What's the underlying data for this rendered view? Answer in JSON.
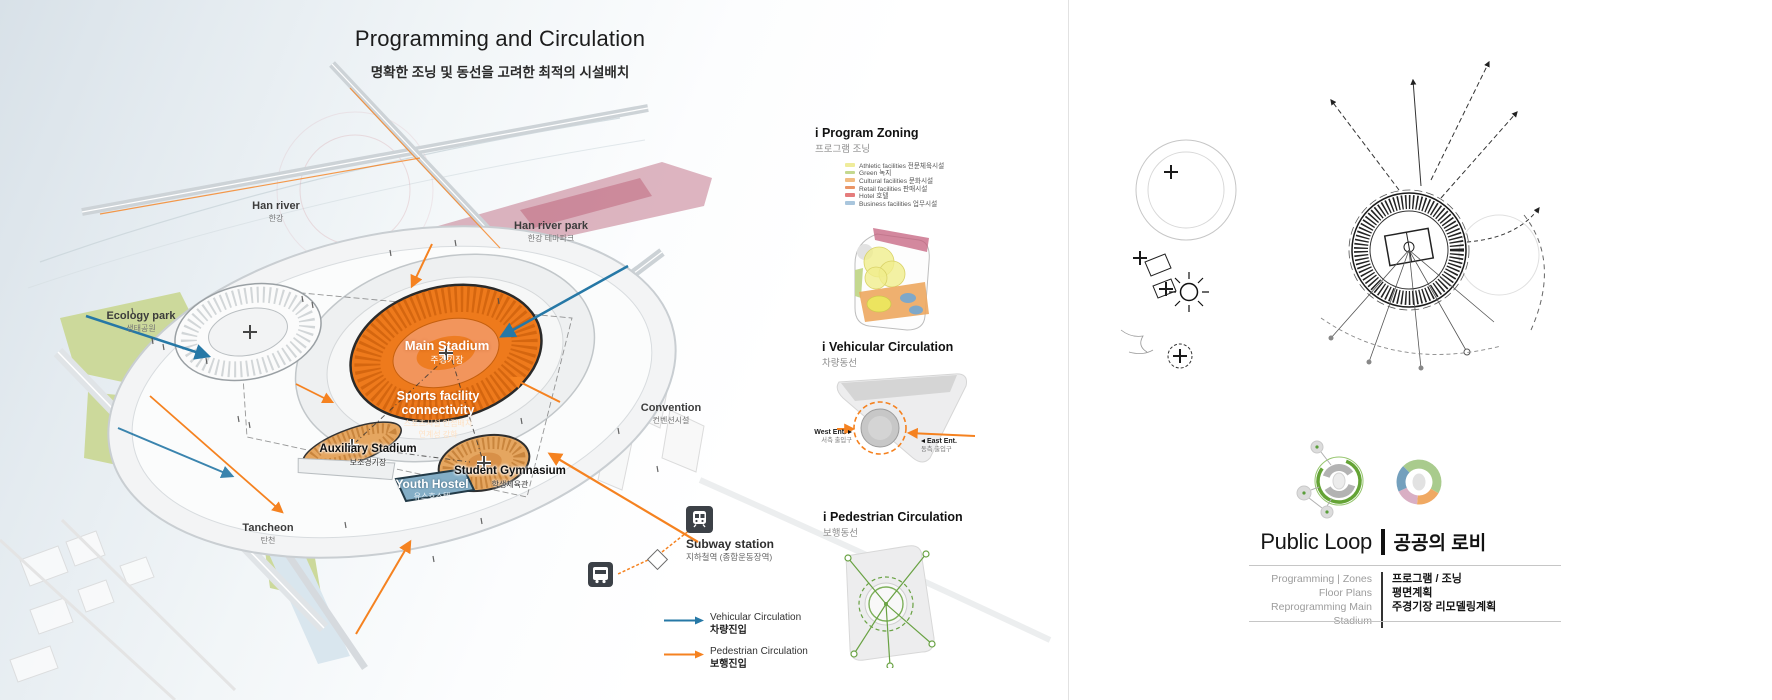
{
  "left_board": {
    "title": "Programming and Circulation",
    "subtitle_ko": "명확한 조닝 및 동선을 고려한 최적의 시설배치",
    "map_labels": {
      "han_river": {
        "en": "Han river",
        "ko": "한강"
      },
      "han_river_park": {
        "en": "Han river park",
        "ko": "한강 테마파크"
      },
      "ecology_park": {
        "en": "Ecology park",
        "ko": "생태공원"
      },
      "tancheon": {
        "en": "Tancheon",
        "ko": "탄천"
      },
      "convention": {
        "en": "Convention",
        "ko": "컨벤션시설"
      },
      "main_stadium": {
        "en": "Main Stadium",
        "ko": "주경기장"
      },
      "connectivity": {
        "en": "Sports facility connectivity",
        "ko1": "스포츠시설 인접배치",
        "ko2": "연계성 강화"
      },
      "auxiliary_stadium": {
        "en": "Auxiliary Stadium",
        "ko": "보조경기장"
      },
      "youth_hostel": {
        "en": "Youth Hostel",
        "ko": "유스호스텔"
      },
      "student_gymnasium": {
        "en": "Student Gymnasium",
        "ko": "학생체육관"
      },
      "subway_station": {
        "en": "Subway station",
        "ko": "지하철역 (종합운동장역)"
      }
    },
    "zoning": {
      "title": "i Program Zoning",
      "subtitle_ko": "프로그램 조닝",
      "legend": [
        {
          "label": "Athletic facilities",
          "ko": "전문체육시설",
          "color": "#efec9b"
        },
        {
          "label": "Green",
          "ko": "녹지",
          "color": "#c4d88f"
        },
        {
          "label": "Cultural facilities",
          "ko": "문화시설",
          "color": "#f2bc82"
        },
        {
          "label": "Retail facilities",
          "ko": "판매시설",
          "color": "#ea9465"
        },
        {
          "label": "Hotel",
          "ko": "호텔",
          "color": "#e57c7c"
        },
        {
          "label": "Business facilities",
          "ko": "업무시설",
          "color": "#a9c6dd"
        }
      ]
    },
    "vehicular": {
      "title": "i Vehicular Circulation",
      "subtitle_ko": "차량동선",
      "west": {
        "label": "West Ent.",
        "ko": "서측 출입구"
      },
      "east": {
        "label": "East Ent.",
        "ko": "동측 출입구"
      }
    },
    "pedestrian": {
      "title": "i Pedestrian Circulation",
      "subtitle_ko": "보행동선"
    },
    "legend": [
      {
        "label": "Vehicular Circulation",
        "ko": "차량진입",
        "color": "#2678a6"
      },
      {
        "label": "Pedestrian Circulation",
        "ko": "보행진입",
        "color": "#f58220"
      }
    ],
    "colors": {
      "main_stadium_orange": "#ee7a1c",
      "facility_tan": "#e5a660",
      "youth_hostel_blue": "#84aec6",
      "park_green": "#ccd99b",
      "river_park_pink": "#c2798c",
      "vehicular_blue": "#2678a6",
      "pedestrian_orange": "#f58220"
    }
  },
  "right_board": {
    "title": "Public Loop",
    "title_ko": "공공의 로비",
    "index": [
      {
        "en": "Programming | Zones",
        "ko": "프로그램 / 조닝"
      },
      {
        "en": "Floor Plans",
        "ko": "평면계획"
      },
      {
        "en": "Reprogramming Main Stadium",
        "ko": "주경기장 리모델링계획"
      }
    ],
    "ring_colors": {
      "green": "#a9cb8d",
      "orange": "#f0a963",
      "pink": "#d9afc4",
      "blue": "#74a0bd",
      "loop_green": "#64a335"
    }
  }
}
